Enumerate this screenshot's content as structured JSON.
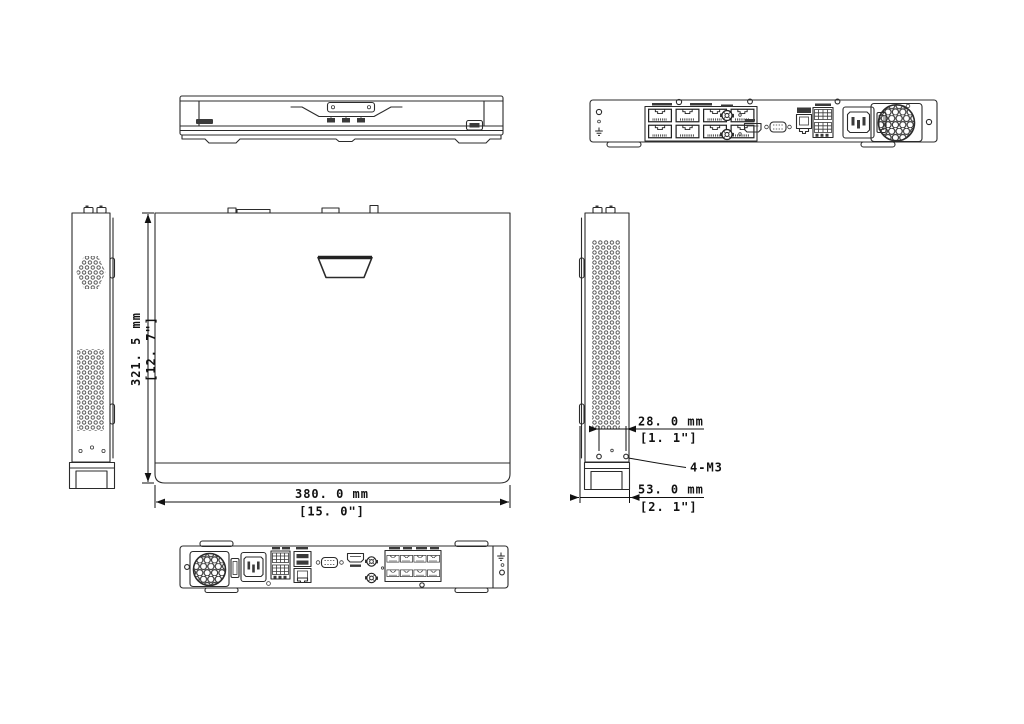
{
  "background": "#ffffff",
  "line_color": "#2b2b2b",
  "dimensions": {
    "depth_mm": "321. 5 mm",
    "depth_in": "[12. 7\"]",
    "width_mm": "380. 0 mm",
    "width_in": "[15. 0\"]",
    "mount_spacing_mm": "28. 0 mm",
    "mount_spacing_in": "[1. 1\"]",
    "side_width_mm": "53. 0 mm",
    "side_width_in": "[2. 1\"]",
    "screw_callout": "4-M3"
  },
  "rear_panel_icons": [
    "ground-terminal-icon",
    "poe-rj45-ports-8x",
    "audio-bnc-connectors-2x",
    "hdmi-port",
    "vga-port",
    "lan-rj45-port",
    "alarm-terminal-block",
    "power-switch",
    "ac-inlet-c14",
    "fan-grille"
  ],
  "front_panel_icons": [
    "brand-logo",
    "status-leds-3x",
    "usb-port"
  ]
}
